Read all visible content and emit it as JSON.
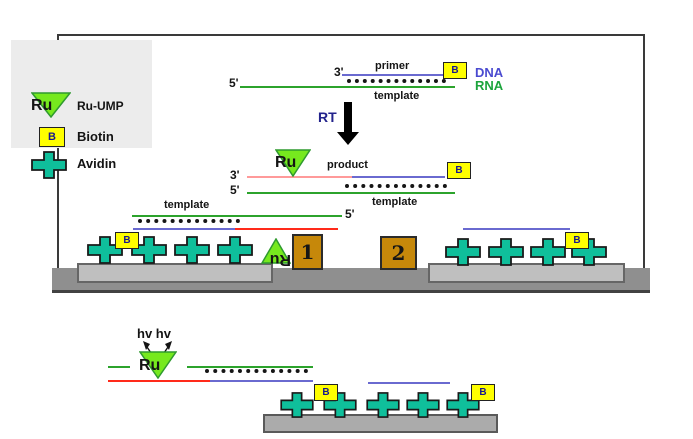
{
  "colors": {
    "dna_blue": "#4a4ad0",
    "rna_green": "#1ca43c",
    "line_blue": "#6a6ad0",
    "line_green": "#2ca32c",
    "line_pink": "#ff9a9a",
    "line_red": "#ff2a1a",
    "rt_navy": "#23238c",
    "ru_triangle_fill": "#76e91e",
    "ru_triangle_stroke": "#2f9a2f",
    "biotin_yellow": "#ffff00",
    "biotin_letter_navy": "#18188c",
    "avidin_teal": "#0fbf9b",
    "electrode_gold": "#c6880a",
    "platform_gray": "#bfbfbf",
    "substrate_gray": "#8f8f8f",
    "legend_bg": "#ececec"
  },
  "legend": {
    "ru_symbol": "Ru",
    "ru_label": "Ru-UMP",
    "biotin_symbol": "B",
    "biotin_label": "Biotin",
    "avidin_label": "Avidin"
  },
  "top_scheme": {
    "three_prime": "3'",
    "five_prime": "5'",
    "primer_label": "primer",
    "template_label": "template",
    "biotin_symbol": "B",
    "dna_label": "DNA",
    "rna_label": "RNA"
  },
  "rt_step": {
    "label": "RT"
  },
  "product_scheme": {
    "ru_symbol": "Ru",
    "product_label": "product",
    "biotin_symbol": "B",
    "three_prime": "3'",
    "five_prime": "5'",
    "template_label": "template"
  },
  "capture_scheme": {
    "template_label": "template",
    "five_prime": "5'",
    "biotin_left": "B",
    "biotin_right": "B",
    "ru_symbol": "Ru",
    "electrode1_label": "1",
    "electrode2_label": "2"
  },
  "emission_scheme": {
    "hv_label": "hv hv",
    "ru_symbol": "Ru",
    "biotin_left": "B",
    "biotin_right": "B"
  }
}
